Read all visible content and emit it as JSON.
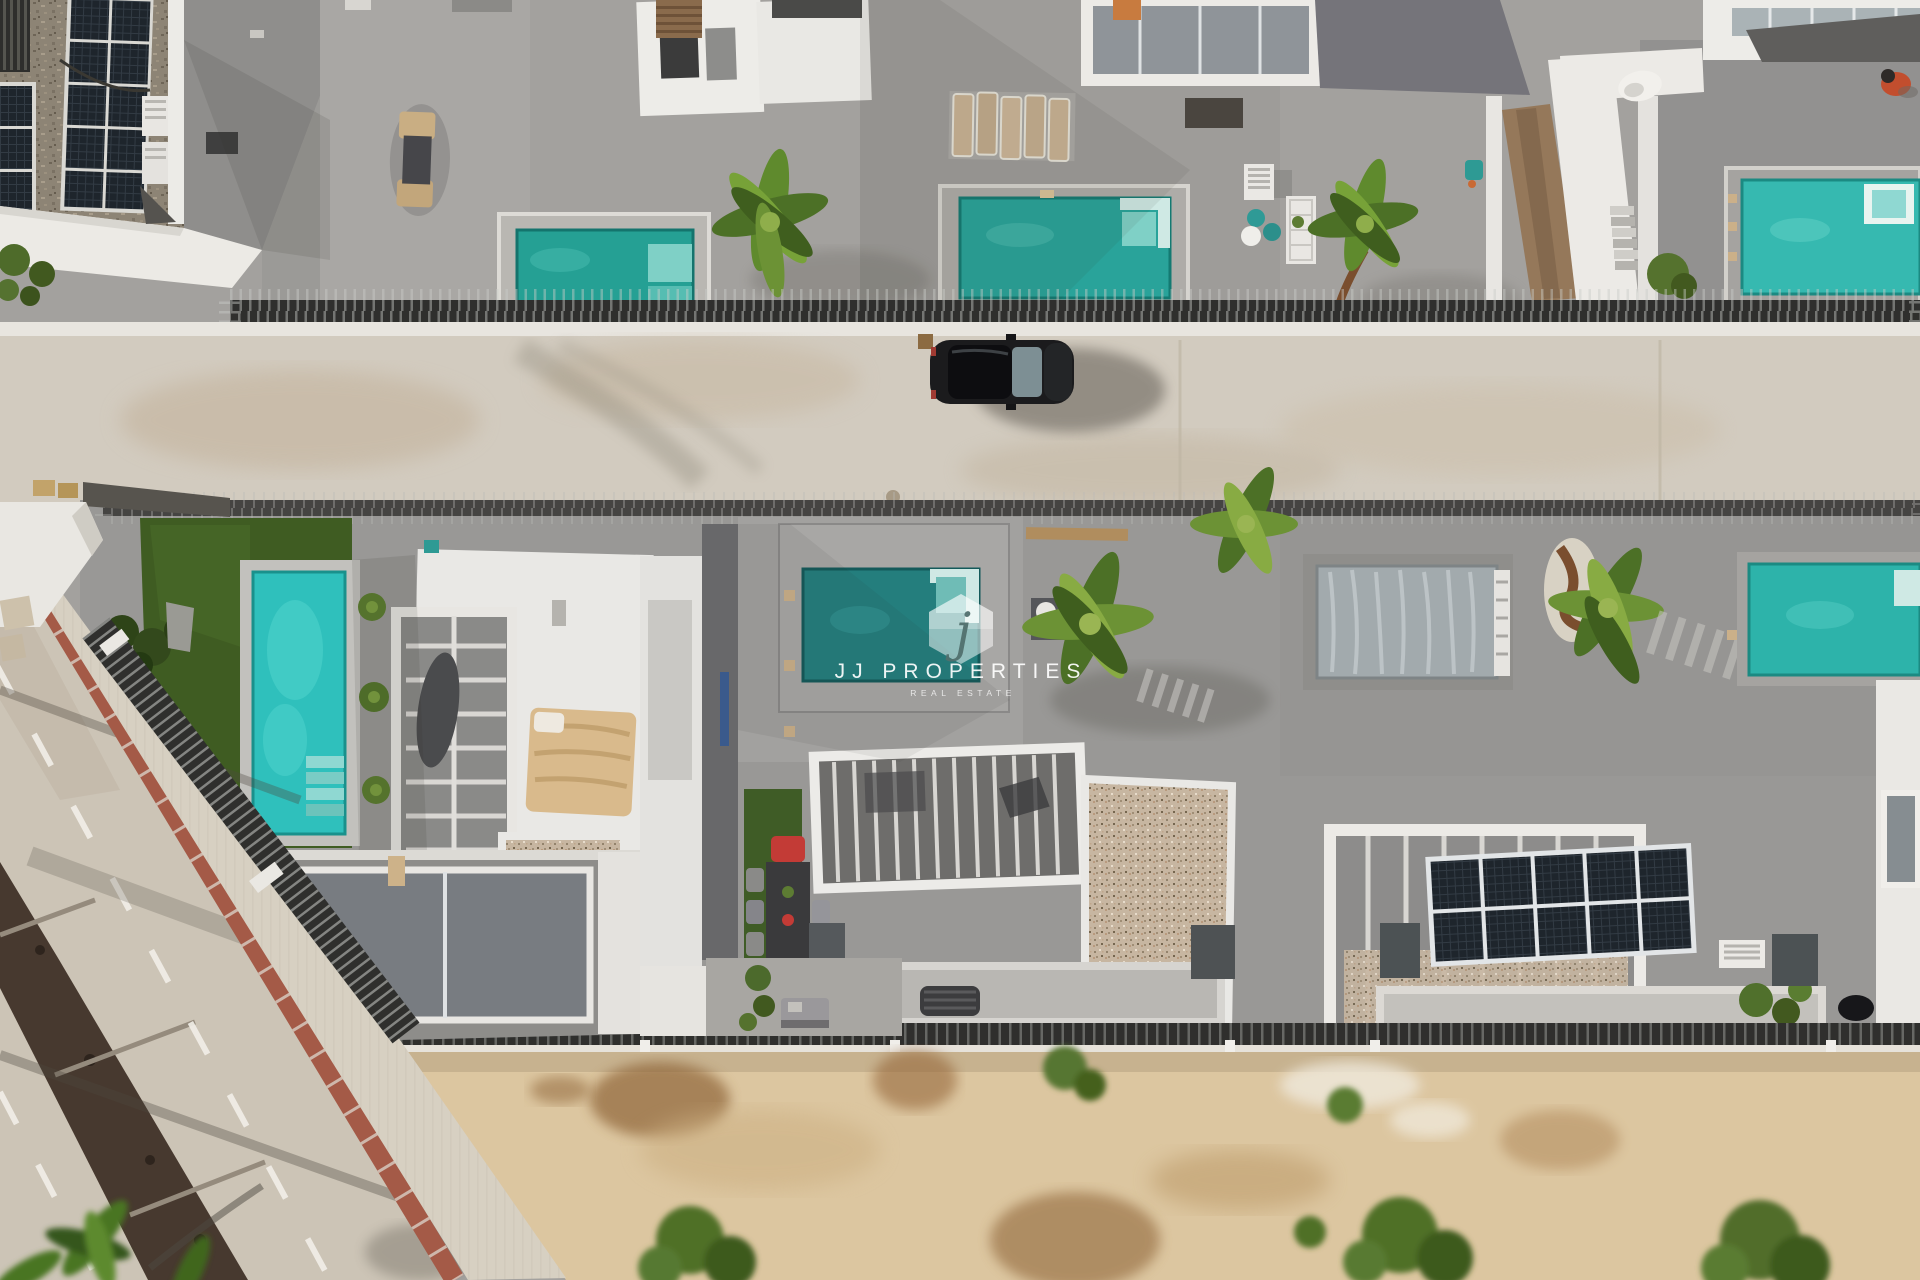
{
  "watermark": {
    "logo_letter": "j",
    "brand_name": "JJ PROPERTIES",
    "tagline": "REAL ESTATE"
  },
  "scene": {
    "type": "aerial-drone-photograph",
    "description": "Top-down aerial view of a row of modern white villas with private turquoise pools and grey roof terraces, a concrete street with a parked dark SUV, a diagonal asphalt road with red edge strip and dashed lane lines at lower left, rooftop solar panels, gravel roofs, palm trees, artificial lawn and a sandy vacant lot with shrubs at the bottom.",
    "elements": [
      "top row of villa terraces with three pools and sun loungers",
      "rock wall with solar panels at top left",
      "parked dark SUV on concrete street",
      "middle row of villas: lawn garden with bright pool, white roof with tan canopy bed, dark pool with dining set, tarp-covered pool, rooftop solar array, bright pool at far right",
      "diagonal road with red strip, sidewalk and hatched drain",
      "sandy lot with green and dried shrubs",
      "JJ Properties hexagon watermark"
    ]
  },
  "palette": {
    "terrace_grey": "#a09e9b",
    "road_concrete": "#d2cbbf",
    "pool_teal": "#2aa49a",
    "pool_bright": "#38c2bd",
    "pool_dark": "#247e7d",
    "lawn_green": "#3f5c22",
    "sand": "#dcc6a0",
    "white_building": "#edece8",
    "car_black": "#1b1b1d",
    "red_strip": "#a45a47",
    "watermark_white": "#ffffff"
  }
}
